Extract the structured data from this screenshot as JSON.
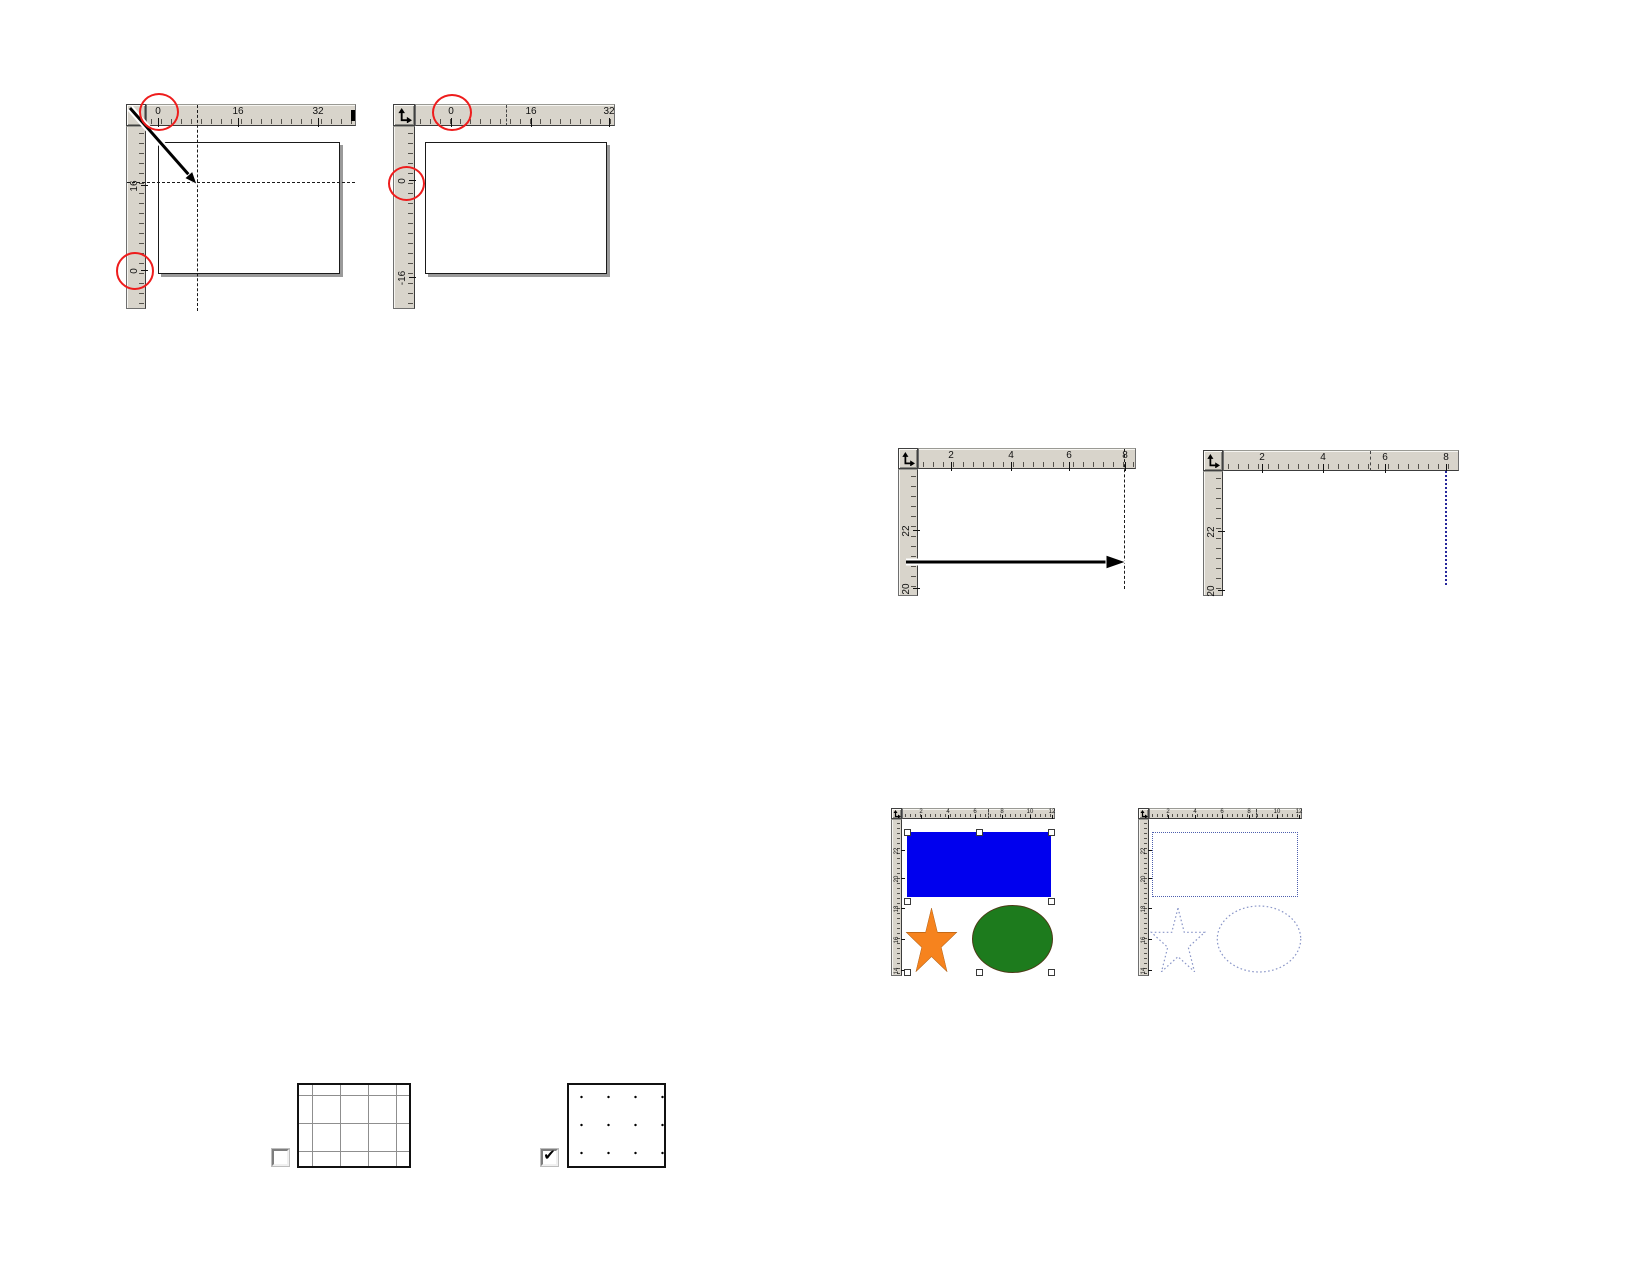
{
  "colors": {
    "ruler_bg": "#d8d4cb",
    "highlight_red": "#ee1c1c",
    "shape_blue": "#0000ee",
    "shape_orange": "#f6831e",
    "shape_green": "#1d7b1d",
    "wireframe_blue": "#8a96c8",
    "wireframe_rect_blue": "#4d5fae",
    "guideline_navy": "#26269b"
  },
  "fig_origin_before": {
    "h_labels": [
      "0",
      "16",
      "32"
    ],
    "v_labels": [
      "16",
      "0"
    ]
  },
  "fig_origin_after": {
    "h_labels": [
      "0",
      "16",
      "32"
    ],
    "v_labels": [
      "0",
      "-16"
    ]
  },
  "fig_guideline_drag": {
    "h_labels": [
      "2",
      "4",
      "6",
      "8"
    ],
    "v_labels": [
      "22",
      "20"
    ]
  },
  "fig_guideline_placed": {
    "h_labels": [
      "2",
      "4",
      "6",
      "8"
    ],
    "v_labels": [
      "22",
      "20"
    ]
  },
  "fig_shapes_normal": {
    "h_labels": [
      "2",
      "4",
      "6",
      "8",
      "10",
      "12"
    ],
    "v_labels": [
      "22",
      "20",
      "18",
      "16",
      "14"
    ]
  },
  "fig_shapes_wireframe": {
    "h_labels": [
      "2",
      "4",
      "6",
      "8",
      "10",
      "12"
    ],
    "v_labels": [
      "22",
      "20",
      "18",
      "16",
      "14"
    ]
  },
  "fig_grid_lines": {
    "checkbox_checked": false
  },
  "fig_grid_dots": {
    "checkbox_checked": true,
    "check_glyph": "✔"
  }
}
